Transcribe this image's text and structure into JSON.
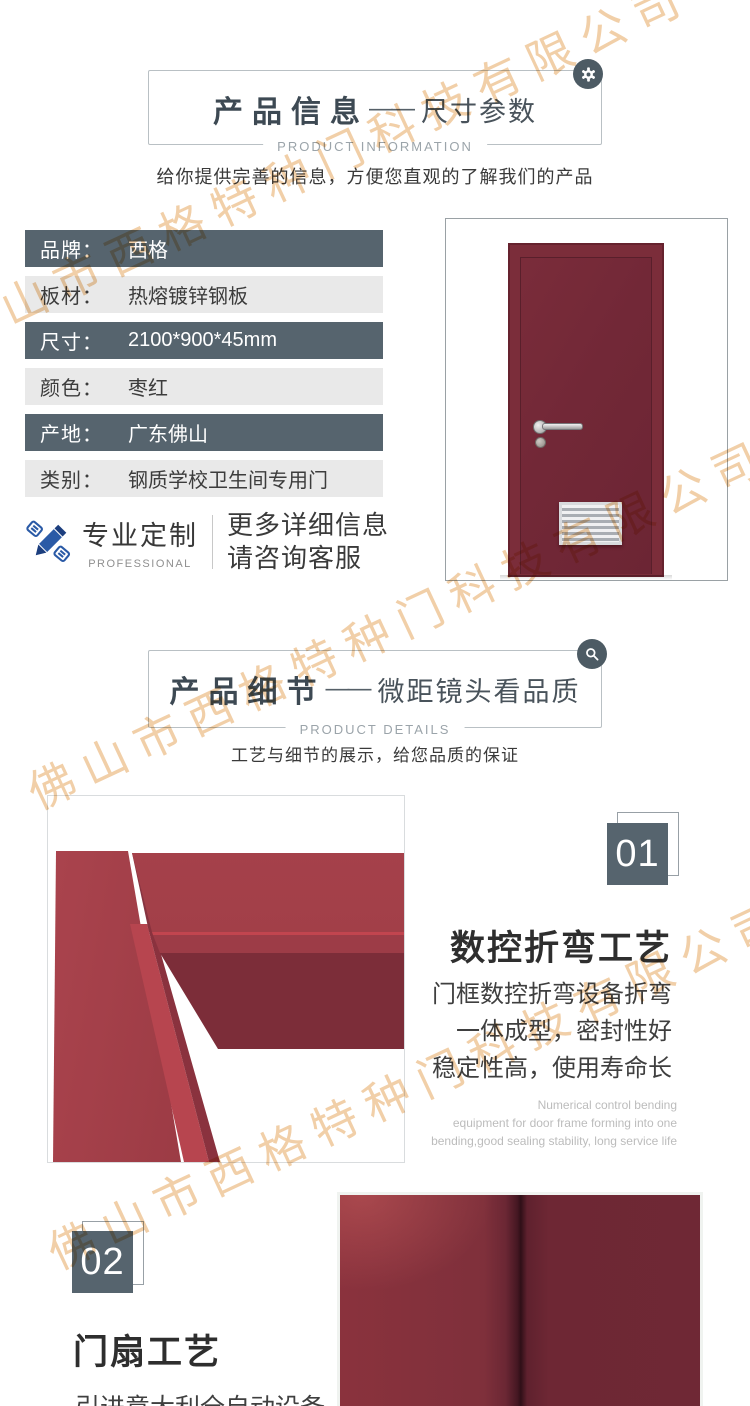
{
  "watermark": {
    "text": "佛山市西格特种门科技有限公司",
    "color": "#f1cfa8"
  },
  "colors": {
    "slate": "#56646e",
    "light_row": "#e9e9e9",
    "door_red": "#722837",
    "frame_red": "#9c3b46",
    "accent_blue": "#2a5aa6"
  },
  "section_info": {
    "title": "产品信息",
    "dash": "——",
    "subtitle_right": "尺寸参数",
    "title_en": "PRODUCT INFORMATION",
    "tagline": "给你提供完善的信息，方便您直观的了解我们的产品",
    "corner_icon": "gear-icon"
  },
  "specs": {
    "rows": [
      {
        "label": "品牌：",
        "value": "西格"
      },
      {
        "label": "板材：",
        "value": "热熔镀锌钢板"
      },
      {
        "label": "尺寸：",
        "value": "2100*900*45mm"
      },
      {
        "label": "颜色：",
        "value": "枣红"
      },
      {
        "label": "产地：",
        "value": "广东佛山"
      },
      {
        "label": "类别：",
        "value": "钢质学校卫生间专用门"
      }
    ]
  },
  "custom_service": {
    "title": "专业定制",
    "title_en": "PROFESSIONAL",
    "line1": "更多详细信息",
    "line2": "请咨询客服",
    "icon": "pencil-icon"
  },
  "section_details": {
    "title": "产品细节",
    "dash": "——",
    "subtitle_right": "微距镜头看品质",
    "title_en": "PRODUCT DETAILS",
    "tagline": "工艺与细节的展示，给您品质的保证",
    "corner_icon": "magnifier-icon"
  },
  "feature_01": {
    "number": "01",
    "heading": "数控折弯工艺",
    "line1": "门框数控折弯设备折弯",
    "line2": "一体成型，密封性好",
    "line3": "稳定性高，使用寿命长",
    "en1": "Numerical control bending",
    "en2": "equipment for door frame forming into one",
    "en3": "bending,good sealing stability, long service life"
  },
  "feature_02": {
    "number": "02",
    "heading": "门扇工艺",
    "body": "引进意大利全自动设备"
  }
}
